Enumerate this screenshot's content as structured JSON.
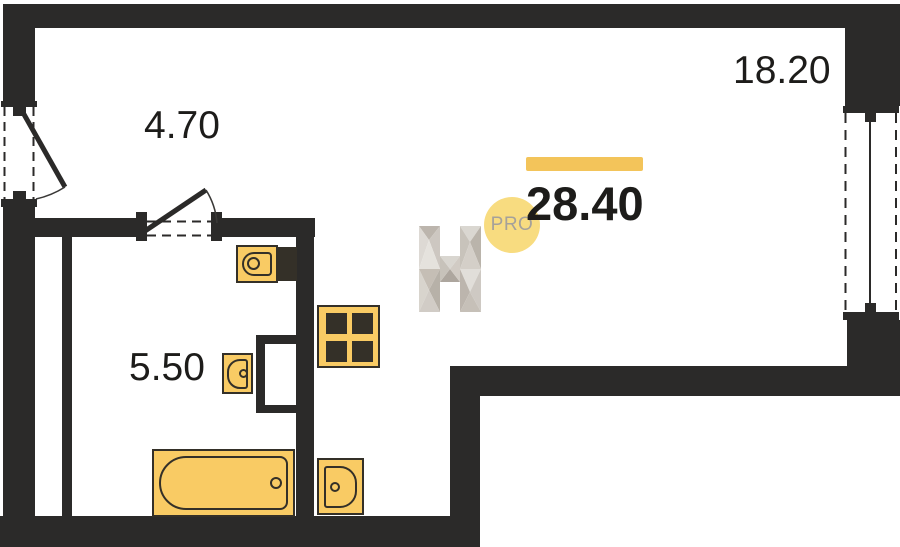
{
  "floorplan": {
    "unit_total_area": "28.40",
    "rooms": [
      {
        "name": "entrance-hall",
        "area": "4.70"
      },
      {
        "name": "living-room",
        "area": "18.20"
      },
      {
        "name": "bathroom",
        "area": "5.50"
      }
    ],
    "watermark": {
      "badge_text": "PRO"
    },
    "fixtures": [
      "toilet",
      "wash-basin",
      "bathtub",
      "stove",
      "kitchen-sink"
    ],
    "openings": [
      "entrance-door",
      "bathroom-door",
      "window"
    ],
    "colors": {
      "wall": "#2b2a29",
      "fixture_fill": "#f9cb64",
      "fixture_outline": "#343028",
      "accent_bar": "#f3c45a",
      "badge_fill": "#f8dc80",
      "badge_text": "#a5a19a",
      "label_text": "#1d1c1a"
    }
  }
}
